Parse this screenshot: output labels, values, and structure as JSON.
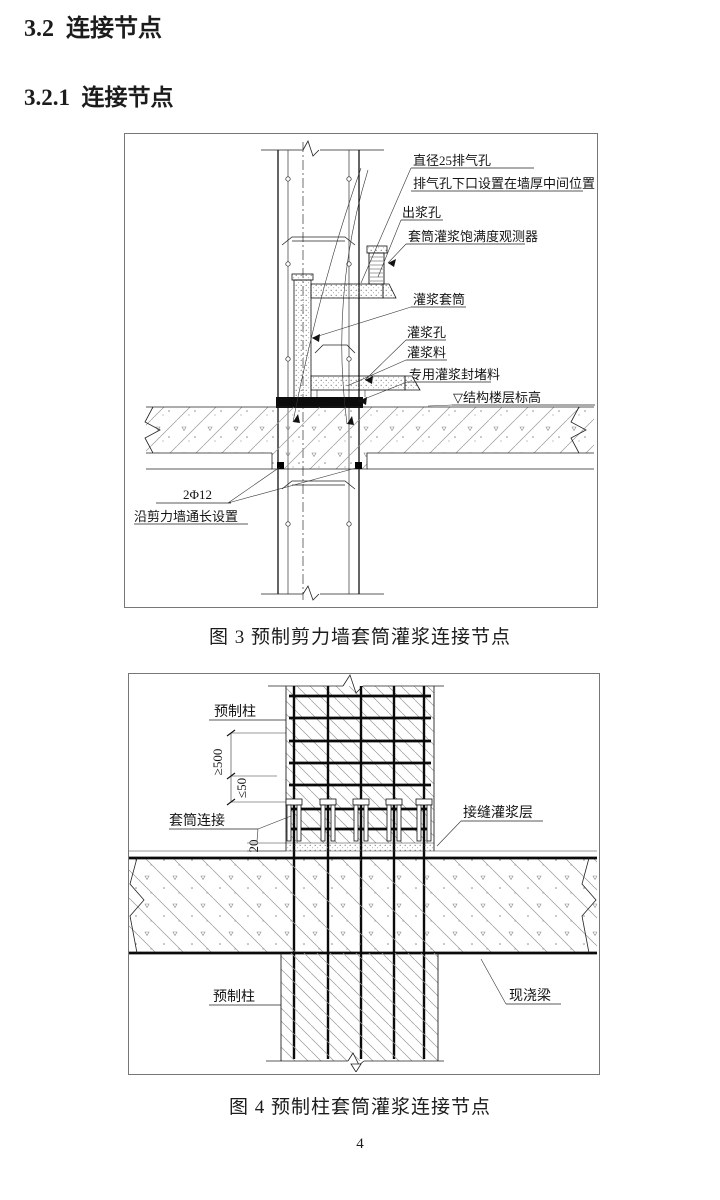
{
  "headings": {
    "section": "3.2  连接节点",
    "subsection": "3.2.1  连接节点"
  },
  "figure3": {
    "caption": "图 3  预制剪力墙套筒灌浆连接节点",
    "labels": {
      "vent_hole": "直径25排气孔",
      "vent_hole_note": "排气孔下口设置在墙厚中间位置",
      "outlet_hole": "出浆孔",
      "observer": "套筒灌浆饱满度观测器",
      "grout_sleeve": "灌浆套筒",
      "grout_hole": "灌浆孔",
      "grout_material": "灌浆料",
      "sealing_material": "专用灌浆封堵料",
      "floor_elevation": "▽结构楼层标高",
      "rebar_spec": "2Φ12",
      "rebar_note": "沿剪力墙通长设置"
    }
  },
  "figure4": {
    "caption": "图 4  预制柱套筒灌浆连接节点",
    "labels": {
      "precast_column_top": "预制柱",
      "precast_column_bottom": "预制柱",
      "sleeve_connection": "套筒连接",
      "joint_grout_layer": "接缝灌浆层",
      "cast_in_place_beam": "现浇梁",
      "dim_embed": "≥500",
      "dim_stirrup": "≤50",
      "dim_joint": "20"
    }
  },
  "page": {
    "number": "4"
  }
}
